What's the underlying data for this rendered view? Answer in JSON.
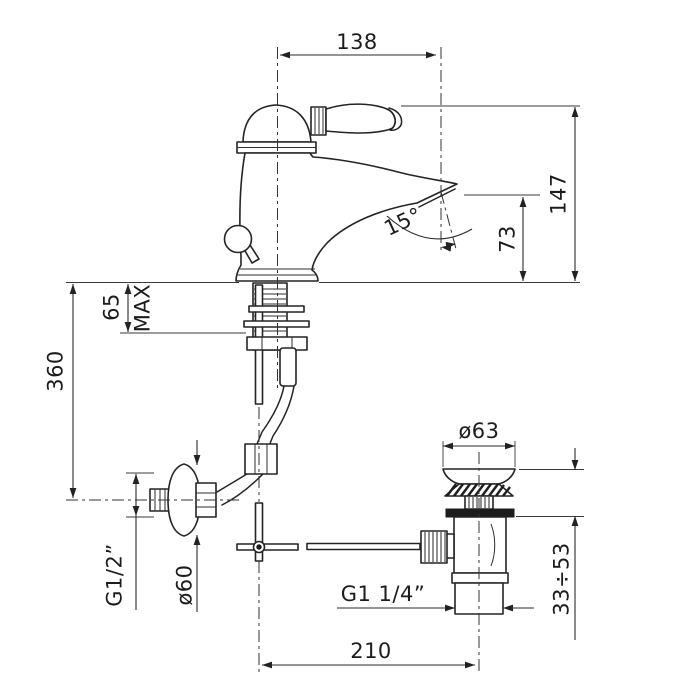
{
  "drawing": {
    "background": "#ffffff",
    "line_color": "#242424",
    "labels": {
      "spout_projection": "138",
      "overall_height": "147",
      "outlet_height": "73",
      "outlet_angle": "15°",
      "max_deck_thickness": "65",
      "max_deck_suffix": "MAX",
      "supply_drop": "360",
      "supply_thread": "G1/2”",
      "escutcheon_diameter": "ø60",
      "waste_flange_diameter": "ø63",
      "clamping_range": "33÷53",
      "waste_thread": "G1 1/4”",
      "rod_to_waste_distance": "210"
    }
  }
}
